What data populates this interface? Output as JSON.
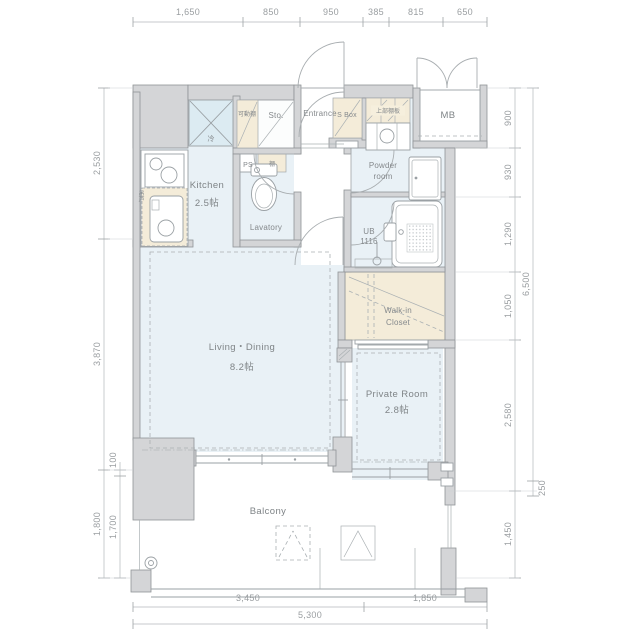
{
  "colors": {
    "floor": "#e9f1f6",
    "fixture_blue": "#dcebf2",
    "storage_beige": "#f4ecd9",
    "wall_fill": "#d4d5d7",
    "wall_stroke": "#8f9396",
    "line": "#9aa0a4",
    "dim_text": "#9a9ea1",
    "label_text": "#7f8487",
    "background": "#ffffff"
  },
  "labels": {
    "entrance": "Entrance",
    "shoe_box": "S Box",
    "upper_shelf": "上部棚板",
    "meter_box": "MB",
    "movable_shelf": "可動棚",
    "storage": "Sto.",
    "refrigerator": "冷",
    "pipe_space": "PS",
    "shelf": "棚",
    "kitchen": "Kitchen",
    "kitchen_size": "2.5帖",
    "hanging_cupboard": "吊戸",
    "lavatory": "Lavatory",
    "powder_room_line1": "Powder",
    "powder_room_line2": "room",
    "unit_bath_line1": "UB",
    "unit_bath_line2": "1116",
    "walkin_closet_line1": "Walk-in",
    "walkin_closet_line2": "Closet",
    "living_dining": "Living・Dining",
    "living_dining_size": "8.2帖",
    "private_room": "Private Room",
    "private_room_size": "2.8帖",
    "balcony": "Balcony"
  },
  "dims": {
    "top": [
      "1,650",
      "850",
      "950",
      "385",
      "815",
      "650"
    ],
    "bottom": [
      "3,450",
      "1,850"
    ],
    "bottom_total": "5,300",
    "left_outer": [
      "2,530",
      "3,870",
      "1,800"
    ],
    "left_inner": [
      "100",
      "1,700"
    ],
    "right_inner": [
      "900",
      "930",
      "1,290",
      "1,050",
      "2,580",
      "1,450"
    ],
    "right_outer": [
      "6,500",
      "250"
    ]
  }
}
